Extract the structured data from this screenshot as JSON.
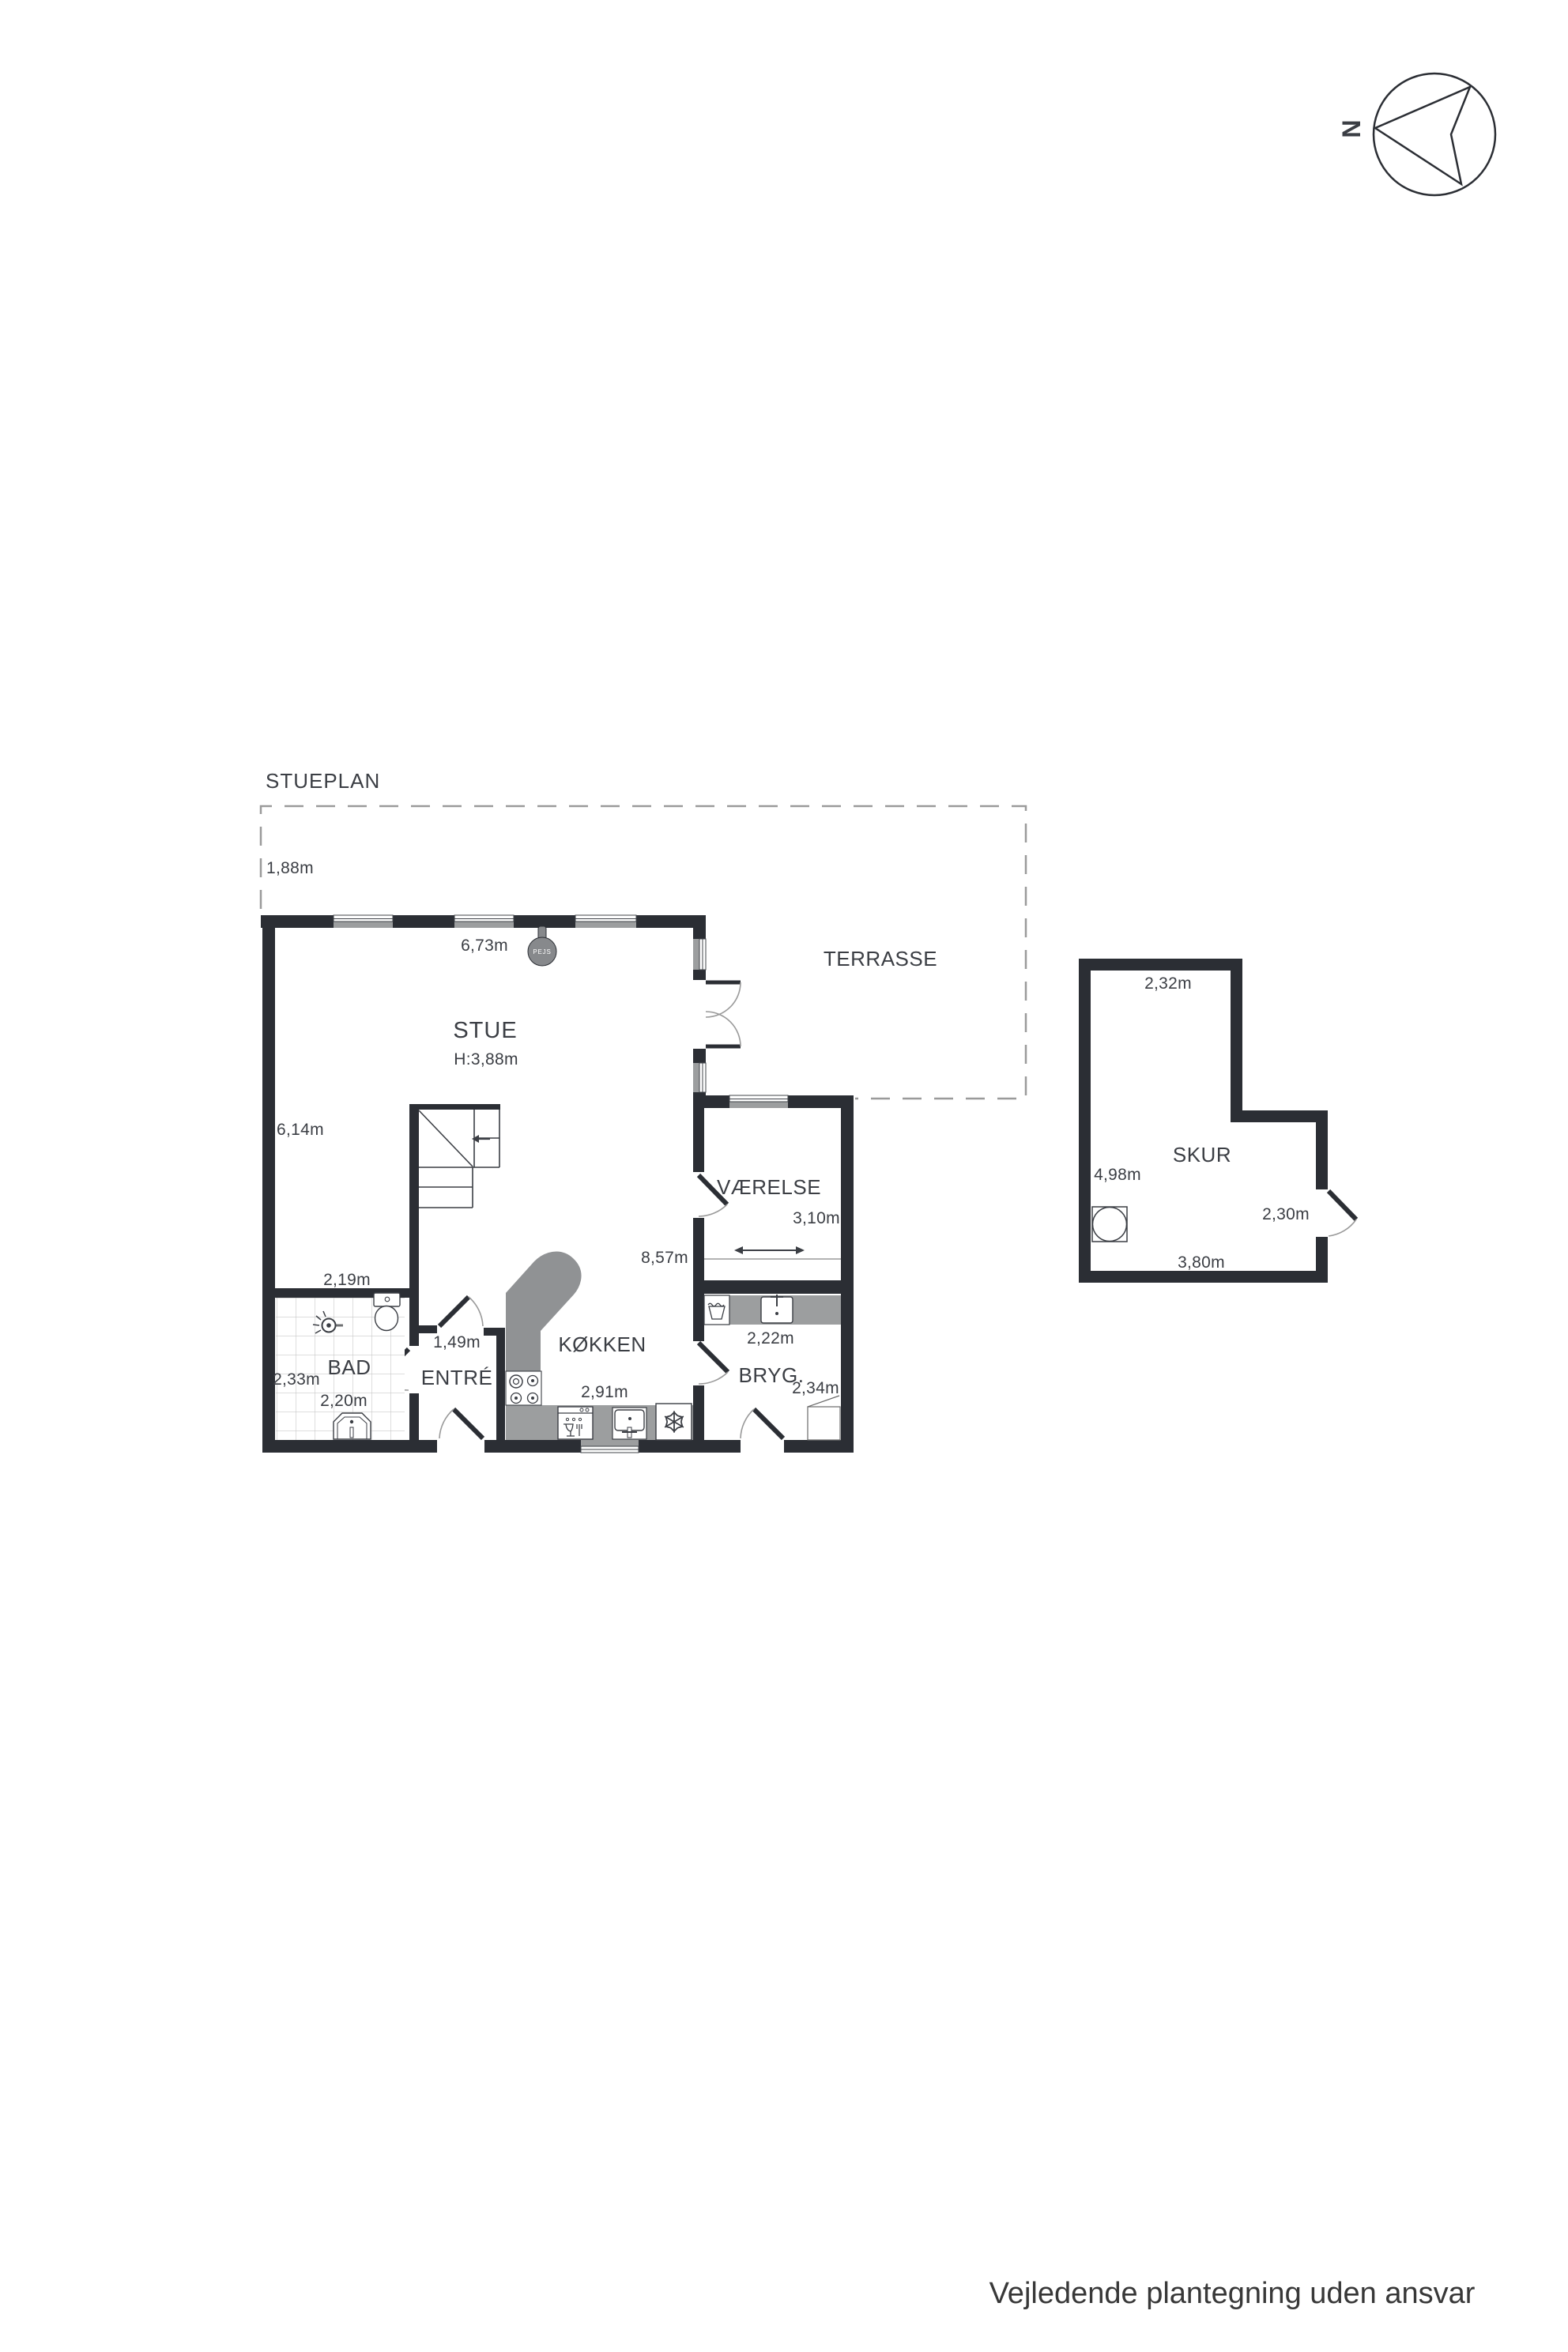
{
  "title": "STUEPLAN",
  "disclaimer": "Vejledende plantegning uden ansvar",
  "compass": {
    "north_label": "N"
  },
  "fixtures": {
    "fireplace_label": "PEJS"
  },
  "dimensions": {
    "house_depth": "8,57m"
  },
  "rooms": {
    "stue": {
      "name": "STUE",
      "ceiling_height": "H:3,88m",
      "width": "6,73m",
      "depth": "6,14m"
    },
    "terrasse": {
      "name": "TERRASSE",
      "depth": "1,88m"
    },
    "vaerelse": {
      "name": "VÆRELSE",
      "width": "3,10m"
    },
    "koekken": {
      "name": "KØKKEN",
      "width": "2,91m"
    },
    "bryg": {
      "name": "BRYG.",
      "width": "2,22m",
      "depth": "2,34m"
    },
    "entre": {
      "name": "ENTRÉ",
      "width": "1,49m"
    },
    "bad": {
      "name": "BAD",
      "width_top": "2,19m",
      "depth": "2,33m",
      "width_bottom": "2,20m"
    },
    "skur": {
      "name": "SKUR",
      "width_top": "2,32m",
      "depth": "4,98m",
      "door_side": "2,30m",
      "width_bottom": "3,80m"
    }
  },
  "colors": {
    "wall": "#2b2e34",
    "window_gray": "#9c9e9f",
    "fixture_gray": "#909294",
    "text": "#3b3e44"
  }
}
